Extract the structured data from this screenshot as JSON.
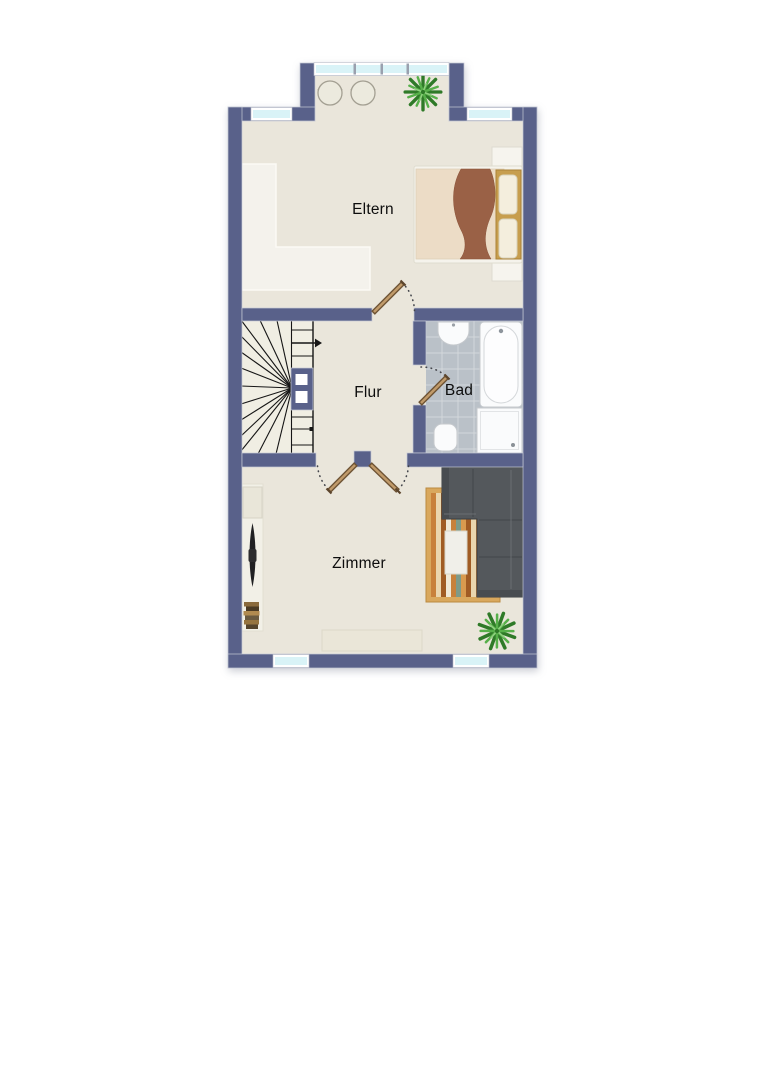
{
  "plan": {
    "type": "floor-plan",
    "labels": {
      "eltern": "Eltern",
      "flur": "Flur",
      "bad": "Bad",
      "zimmer": "Zimmer"
    },
    "colors": {
      "background": "#ffffff",
      "wall": "#59618a",
      "floor": "#eae6db",
      "light_furniture": "#f4f2ec",
      "window_glass": "#d9f3f7",
      "bath_tile": "#bac1c8",
      "tile_grout": "#d3d7db",
      "stair_line": "#161616",
      "door_leaf": "#c09a6a",
      "sofa": "#54585c",
      "rug": "#d9a85d",
      "bed_blanket": "#9a6146",
      "bed_headboard": "#c79e4e",
      "plant": "#2f7a28",
      "label_text": "#0d0d0d"
    }
  }
}
